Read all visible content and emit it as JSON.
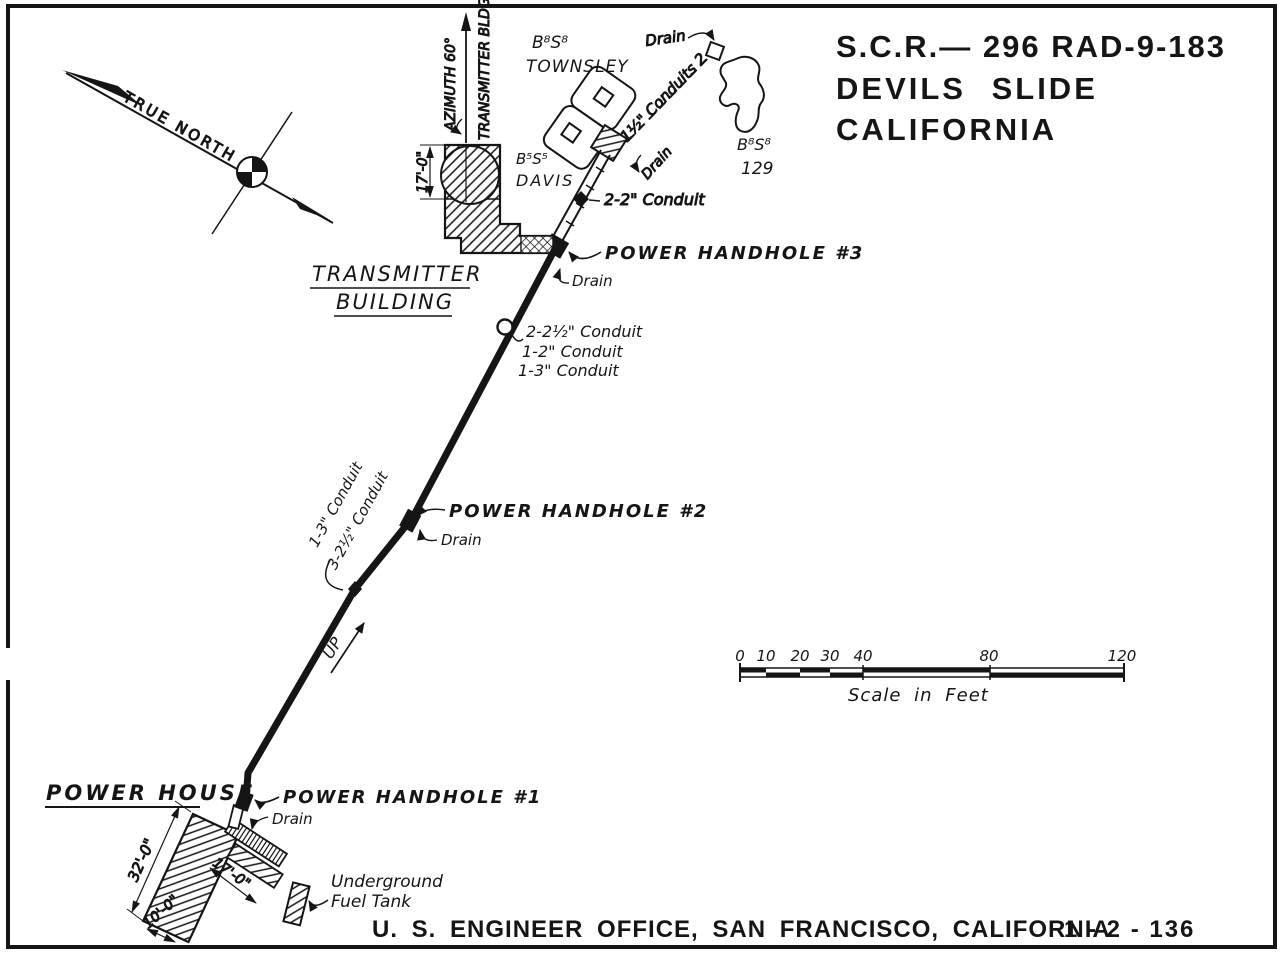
{
  "title": {
    "line1": "S.C.R.— 296 RAD-9-183",
    "line2": "DEVILS SLIDE",
    "line3": "CALIFORNIA"
  },
  "compass": {
    "true_north": "TRUE NORTH"
  },
  "azimuth": {
    "angle_label": "AZIMUTH 60°",
    "bldg_label": "TRANSMITTER BLDG."
  },
  "townsley": {
    "designation": "B⁸S⁸",
    "name": "TOWNSLEY"
  },
  "davis": {
    "designation": "B⁵S⁵",
    "name": "DAVIS"
  },
  "battery129": {
    "designation": "B⁸S⁸",
    "number": "129"
  },
  "transmitter_building": {
    "label_line1": "TRANSMITTER",
    "label_line2": "BUILDING",
    "height_dim": "17'-0\""
  },
  "power_house": {
    "label": "POWER HOUSE",
    "dim_long": "32'-0\"",
    "dim_width": "17'-0\"",
    "dim_short": "10'-0\""
  },
  "fuel_tank": {
    "line1": "Underground",
    "line2": "Fuel Tank"
  },
  "handholes": {
    "h1": "POWER HANDHOLE #1",
    "h2": "POWER HANDHOLE #2",
    "h3": "POWER HANDHOLE #3"
  },
  "drain_label": "Drain",
  "conduit_labels": {
    "dashed_top": "1½\" Conduits 2",
    "upper": "2-2\" Conduit",
    "mid": [
      "2-2½\" Conduit",
      "1-2\" Conduit",
      "1-3\" Conduit"
    ],
    "lower": [
      "1-3\" Conduit",
      "3-2½\" Conduit"
    ],
    "up": "UP"
  },
  "scale_bar": {
    "ticks": [
      "0",
      "10",
      "20",
      "30",
      "40",
      "80",
      "120"
    ],
    "caption": "Scale in Feet"
  },
  "footer": {
    "office": "U. S. ENGINEER OFFICE, SAN FRANCISCO, CALIFORNIA",
    "drawing_number": "1 - 2 - 136"
  },
  "colors": {
    "ink": "#151515",
    "paper": "#ffffff"
  }
}
